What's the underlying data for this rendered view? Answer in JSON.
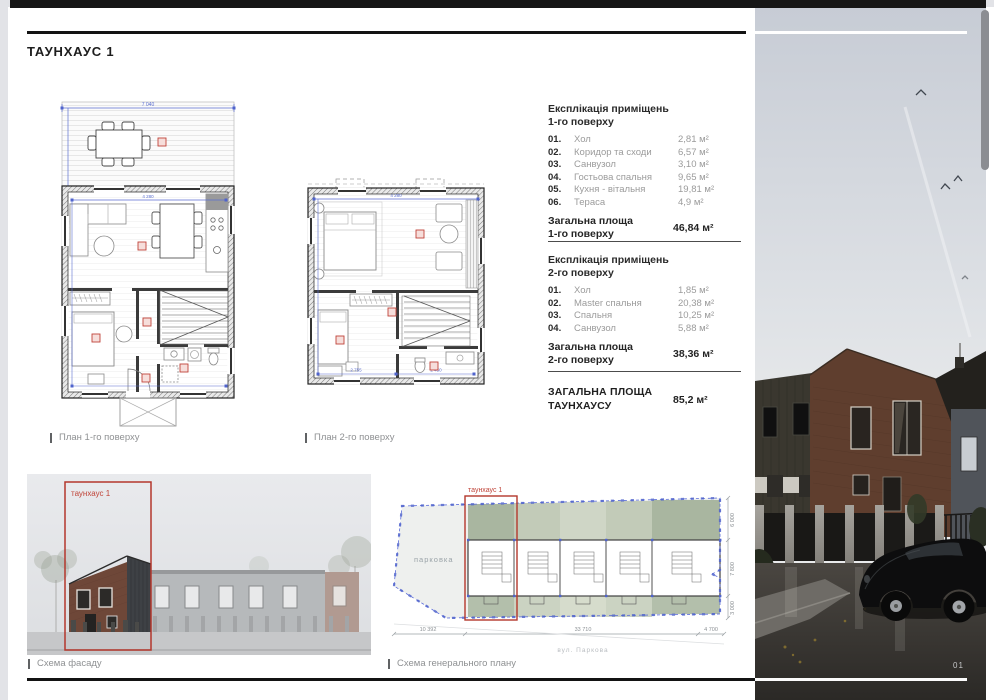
{
  "page": {
    "title": "ТАУНХАУС 1",
    "page_number": "01"
  },
  "explication1": {
    "title_line1": "Експлікація приміщень",
    "title_line2": "1-го поверху",
    "rows": [
      {
        "num": "01.",
        "name": "Хол",
        "area": "2,81 м²"
      },
      {
        "num": "02.",
        "name": "Коридор та сходи",
        "area": "6,57 м²"
      },
      {
        "num": "03.",
        "name": "Санвузол",
        "area": "3,10 м²"
      },
      {
        "num": "04.",
        "name": "Гостьова спальня",
        "area": "9,65 м²"
      },
      {
        "num": "05.",
        "name": "Кухня - вітальня",
        "area": "19,81 м²"
      },
      {
        "num": "06.",
        "name": "Тераса",
        "area": "4,9 м²"
      }
    ],
    "total_label_line1": "Загальна площа",
    "total_label_line2": "1-го поверху",
    "total_value": "46,84 м²"
  },
  "explication2": {
    "title_line1": "Експлікація приміщень",
    "title_line2": "2-го поверху",
    "rows": [
      {
        "num": "01.",
        "name": "Хол",
        "area": "1,85 м²"
      },
      {
        "num": "02.",
        "name": "Master спальня",
        "area": "20,38 м²"
      },
      {
        "num": "03.",
        "name": "Спальня",
        "area": "10,25 м²"
      },
      {
        "num": "04.",
        "name": "Санвузол",
        "area": "5,88 м²"
      }
    ],
    "total_label_line1": "Загальна площа",
    "total_label_line2": "2-го поверху",
    "total_value": "38,36 м²"
  },
  "grand_total": {
    "label_line1": "ЗАГАЛЬНА ПЛОЩА",
    "label_line2": "ТАУНХАУСУ",
    "value": "85,2 м²"
  },
  "plans": {
    "plan1_caption": "План 1-го поверху",
    "plan2_caption": "План 2-го поверху",
    "plan1_width_dim": "7 040",
    "plan1_inner_dim": "4 280",
    "plan2_top_dim": "4 280",
    "plan2_dim_a": "2 755",
    "plan2_dim_b": "2 450"
  },
  "facade": {
    "caption": "Схема фасаду",
    "highlight_label": "таунхаус 1"
  },
  "siteplan": {
    "caption": "Схема генерального плану",
    "highlight_label": "таунхаус 1",
    "parking_label": "парковка",
    "street_label": "вул. Паркова",
    "dim_left": "10 392",
    "dim_center": "33 710",
    "dim_right": "4 700",
    "dim_v_top": "6 000",
    "dim_v_mid": "7 800",
    "dim_v_bottom": "3 000"
  },
  "colors": {
    "accent_red": "#b4372c",
    "dim_blue": "#4f63cc",
    "bar_black": "#131313"
  }
}
